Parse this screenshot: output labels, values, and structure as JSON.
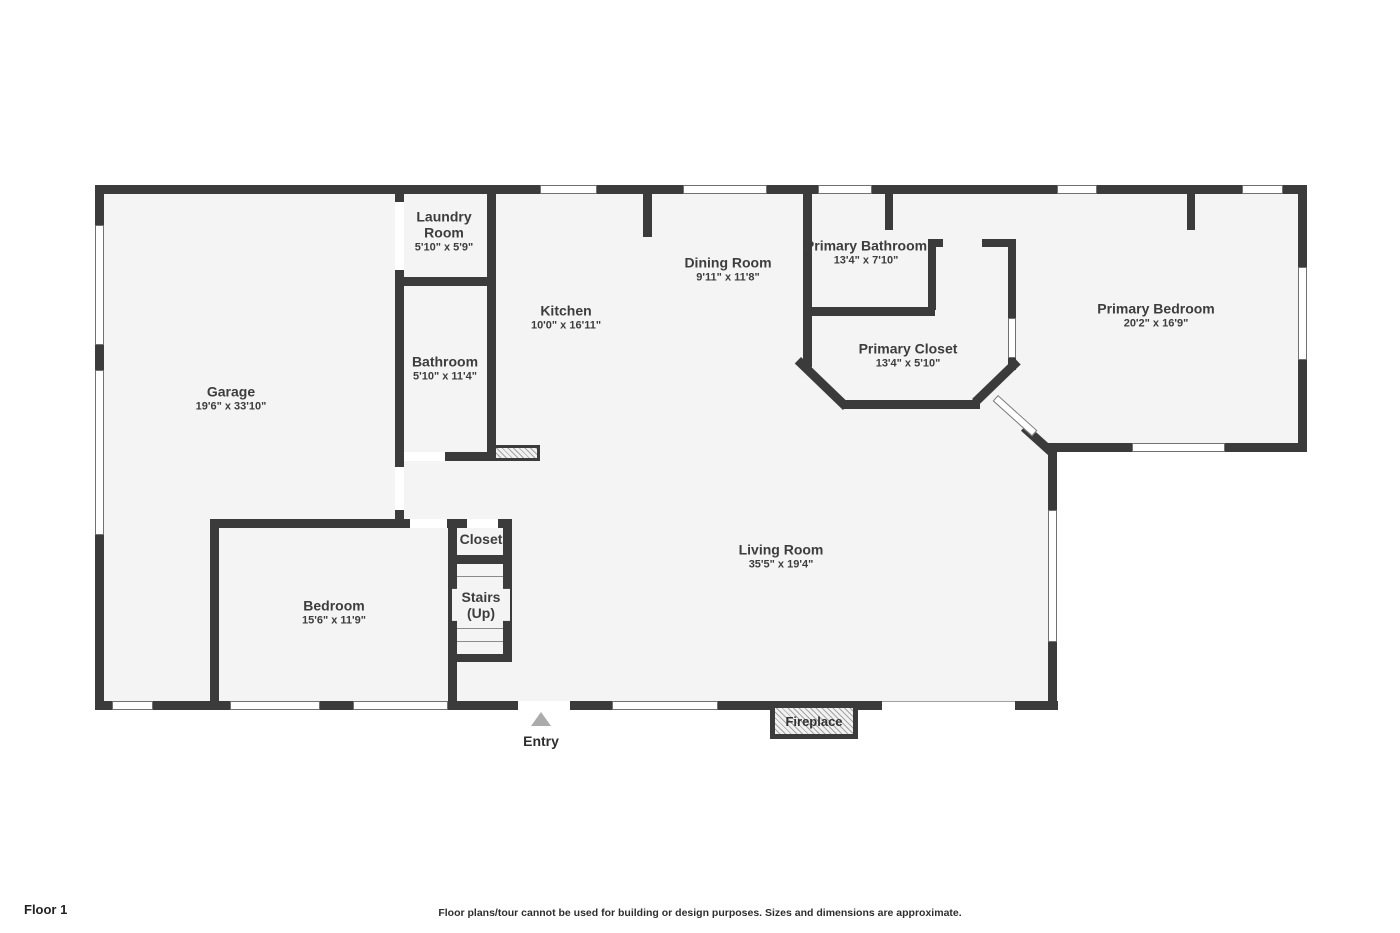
{
  "footer": {
    "floor_label": "Floor 1",
    "disclaimer": "Floor plans/tour cannot be used for building or design purposes. Sizes and dimensions are approximate."
  },
  "markers": {
    "entry": "Entry",
    "fireplace": "Fireplace"
  },
  "rooms": [
    {
      "name": "Laundry Room",
      "dims": "5'10\" x 5'9\""
    },
    {
      "name": "Bathroom",
      "dims": "5'10\" x 11'4\""
    },
    {
      "name": "Garage",
      "dims": "19'6\" x 33'10\""
    },
    {
      "name": "Kitchen",
      "dims": "10'0\" x 16'11\""
    },
    {
      "name": "Dining Room",
      "dims": "9'11\" x 11'8\""
    },
    {
      "name": "Primary Bathroom",
      "dims": "13'4\" x 7'10\""
    },
    {
      "name": "Primary Closet",
      "dims": "13'4\" x 5'10\""
    },
    {
      "name": "Primary Bedroom",
      "dims": "20'2\" x 16'9\""
    },
    {
      "name": "Living Room",
      "dims": "35'5\" x 19'4\""
    },
    {
      "name": "Bedroom",
      "dims": "15'6\" x 11'9\""
    },
    {
      "name": "Closet",
      "dims": ""
    },
    {
      "name": "Stairs (Up)",
      "dims": ""
    }
  ],
  "colors": {
    "wall": "#3b3b3b",
    "floor": "#f4f4f4",
    "window_border": "#717171",
    "entry_arrow": "#ababab"
  }
}
